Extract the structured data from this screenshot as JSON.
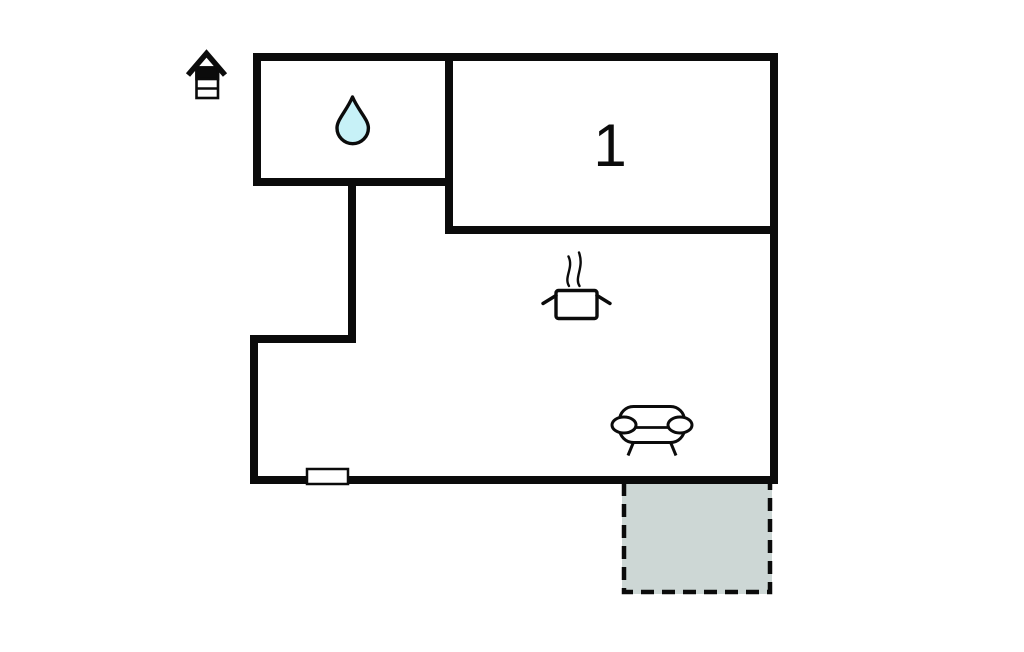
{
  "canvas": {
    "width": 1024,
    "height": 652,
    "background": "#ffffff"
  },
  "floorplan": {
    "rooms": [
      {
        "label": "1"
      }
    ],
    "icons": [
      "house-icon",
      "water-drop-icon",
      "steam-pot-icon",
      "sofa-icon"
    ],
    "terrace": {
      "border_style": "dashed"
    },
    "colors": {
      "wall": "#0b0b0b",
      "icon_stroke": "#0b0b0b",
      "water_drop_fill": "#c7f1f7",
      "terrace_fill": "#cdd7d5",
      "window_fill": "#ffffff"
    }
  }
}
